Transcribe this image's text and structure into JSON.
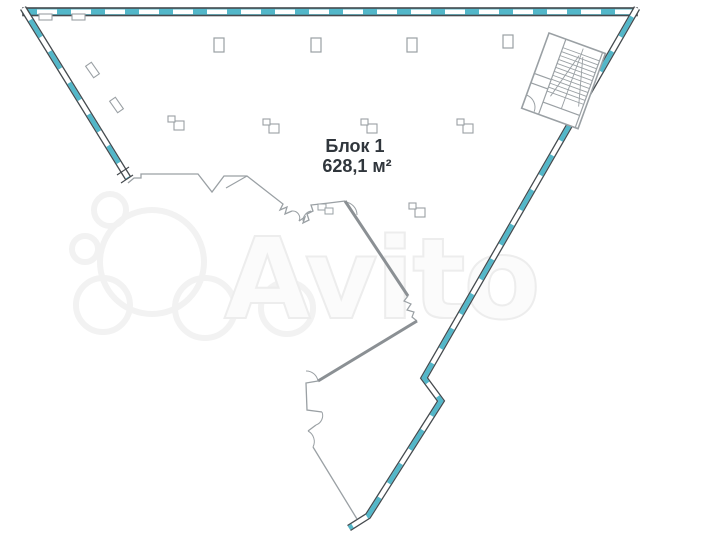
{
  "watermark": {
    "text": "Avito"
  },
  "block": {
    "name": "Блок 1",
    "area": "628,1 м²"
  },
  "colors": {
    "window": "#53b7c9",
    "wall": "#454a4e",
    "interior": "#9aa0a4",
    "interior_dark": "#8b9094",
    "label_text": "#30363c",
    "watermark": "#ededed"
  }
}
